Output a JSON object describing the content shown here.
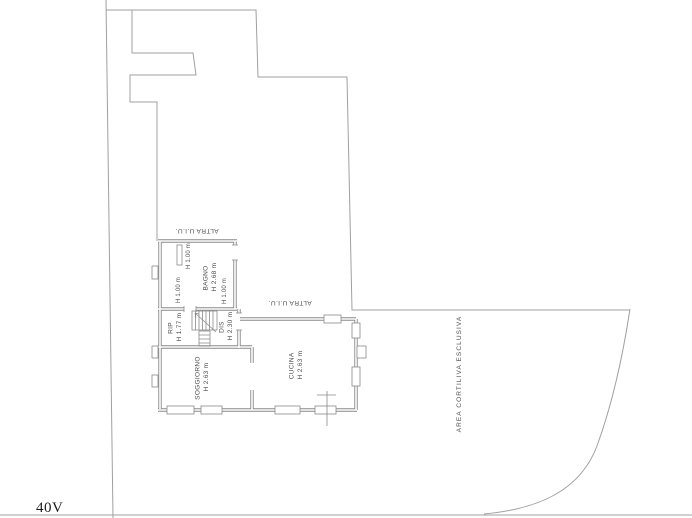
{
  "drawing": {
    "sheet_code": "40V",
    "area_label": "AREA CORTILIVA ESCLUSIVA",
    "other_unit_label": "ALTRA U.I.U.",
    "rooms": {
      "bagno": {
        "name": "BAGNO",
        "height": "H 2.68 m"
      },
      "soggiorno": {
        "name": "SOGGIORNO",
        "height": "H 2.63 m"
      },
      "cucina": {
        "name": "CUCINA",
        "height": "H 2.63 m"
      },
      "rip": {
        "name": "RIP",
        "height": "H 1.77 m"
      },
      "dis": {
        "name": "DIS",
        "height": "H 2.30 m"
      }
    },
    "height_marks": [
      "H 1.00 m",
      "H 1.00 m",
      "H 1.00 m"
    ],
    "colors": {
      "boundary": "#a0a0a0",
      "wall": "#8a8a8a",
      "text": "#4d4d4d",
      "background": "#ffffff"
    }
  }
}
